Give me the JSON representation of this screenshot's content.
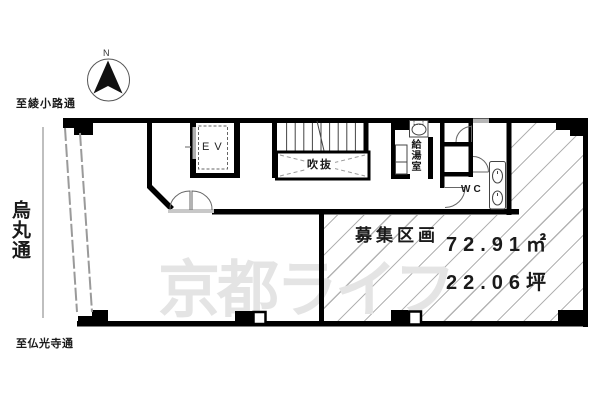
{
  "labels": {
    "north": "N",
    "street_top": "至綾小路通",
    "street_left": "烏丸通",
    "street_bottom": "至仏光寺通",
    "elevator": "EV",
    "atrium": "吹抜",
    "kitchenette": "給湯室",
    "wc": "WC",
    "available_unit": "募集区画",
    "area_m2": "72.91㎡",
    "area_tsubo": "22.06坪",
    "watermark": "京都ライフ"
  },
  "colors": {
    "wall": "#000000",
    "hatch_line": "#b3b3b3",
    "watermark": "#e4e4e4",
    "glazing": "#9a9a9a",
    "background": "#ffffff"
  }
}
